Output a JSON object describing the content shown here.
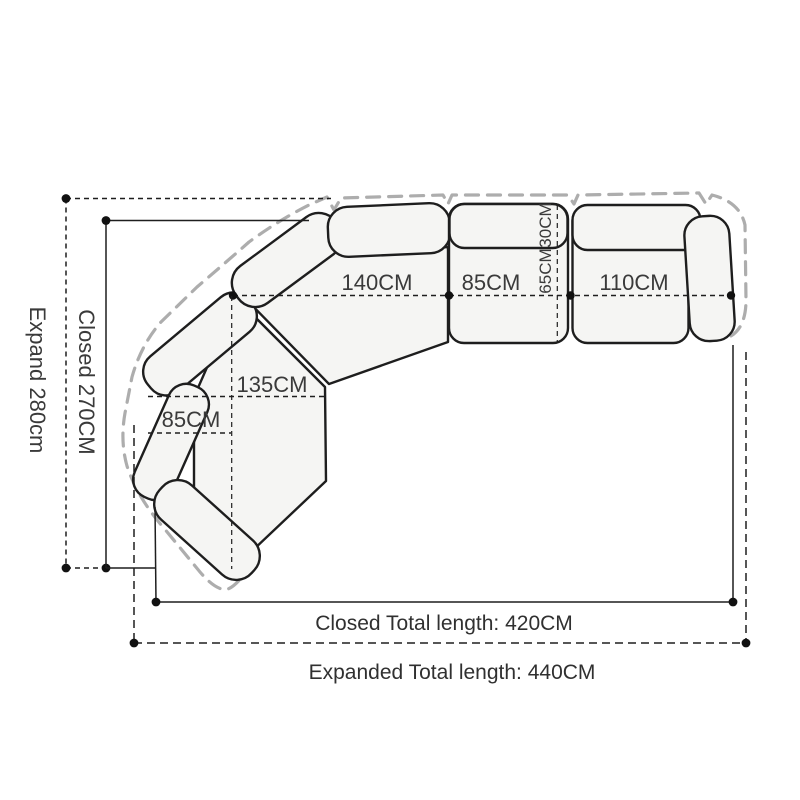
{
  "diagram_title": "sectional-sofa-dimension-diagram",
  "colors": {
    "background": "#ffffff",
    "line": "#1e1e1e",
    "expanded_outline": "#adadad",
    "sofa_fill": "#f5f5f3",
    "text": "#3a3a3a"
  },
  "labels": {
    "seat_140": "140CM",
    "seat_85_right": "85CM",
    "seat_110": "110CM",
    "back_depth_30": "30CM",
    "seat_depth_65": "65CM",
    "corner_135": "135CM",
    "chaise_85_left": "85CM",
    "closed_side_vertical": "Closed 270CM",
    "expand_side_vertical": "Expand 280cm",
    "closed_total_bottom": "Closed Total length: 420CM",
    "expanded_total_bottom": "Expanded Total length: 440CM"
  }
}
